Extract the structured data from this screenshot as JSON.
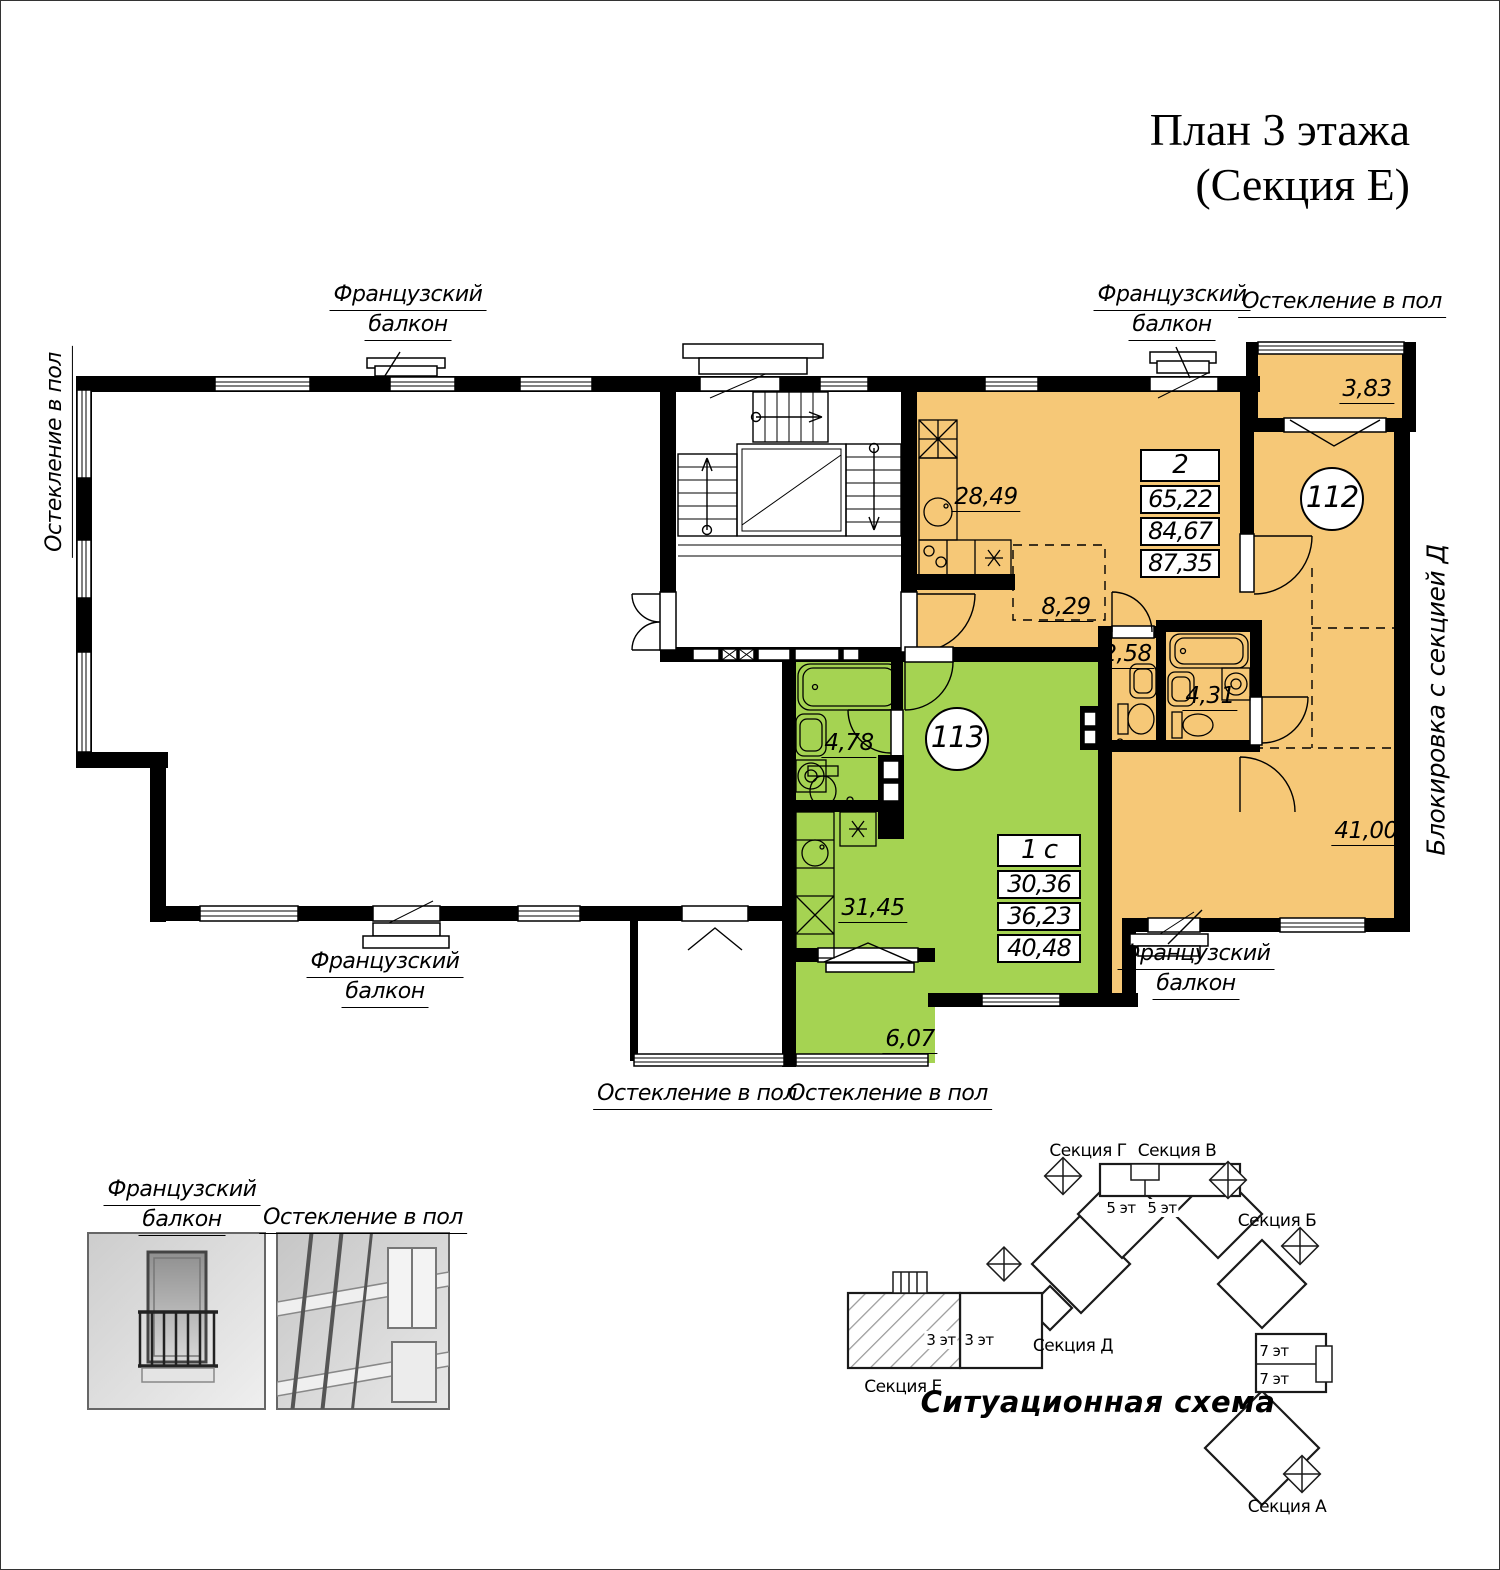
{
  "title": {
    "line1": "План 3 этажа",
    "line2": "(Секция Е)"
  },
  "plan_labels": {
    "french_balcony": {
      "line1": "Французский",
      "line2": "балкон"
    },
    "glazing": "Остекление в пол",
    "blocking": "Блокировка с секцией Д"
  },
  "apartments": {
    "apt112": {
      "number": "112",
      "rooms_count": "2",
      "areas": {
        "living": "65,22",
        "apartment": "84,67",
        "total": "87,35"
      },
      "room_areas": {
        "kitchen": "28,49",
        "hall": "8,29",
        "wc": "2,58",
        "bathroom": "4,31",
        "room": "41,00",
        "balcony": "3,83"
      },
      "color": "#f6c877"
    },
    "apt113": {
      "number": "113",
      "rooms_count": "1 с",
      "areas": {
        "living": "30,36",
        "apartment": "36,23",
        "total": "40,48"
      },
      "room_areas": {
        "bathroom": "4,78",
        "room": "31,45",
        "balcony": "6,07"
      },
      "color": "#a5d352"
    }
  },
  "legend": {
    "french_balcony": {
      "line1": "Французский",
      "line2": "балкон"
    },
    "glazing": "Остекление в пол"
  },
  "scheme": {
    "title": "Ситуационная схема",
    "sections": {
      "g": "Секция Г",
      "v": "Секция В",
      "b": "Секция Б",
      "d": "Секция Д",
      "e": "Секция Е",
      "a": "Секция А"
    },
    "floors": {
      "f5a": "5 эт",
      "f5b": "5 эт",
      "f3a": "3 эт",
      "f3b": "3 эт",
      "f7a": "7 эт",
      "f7b": "7 эт"
    }
  }
}
